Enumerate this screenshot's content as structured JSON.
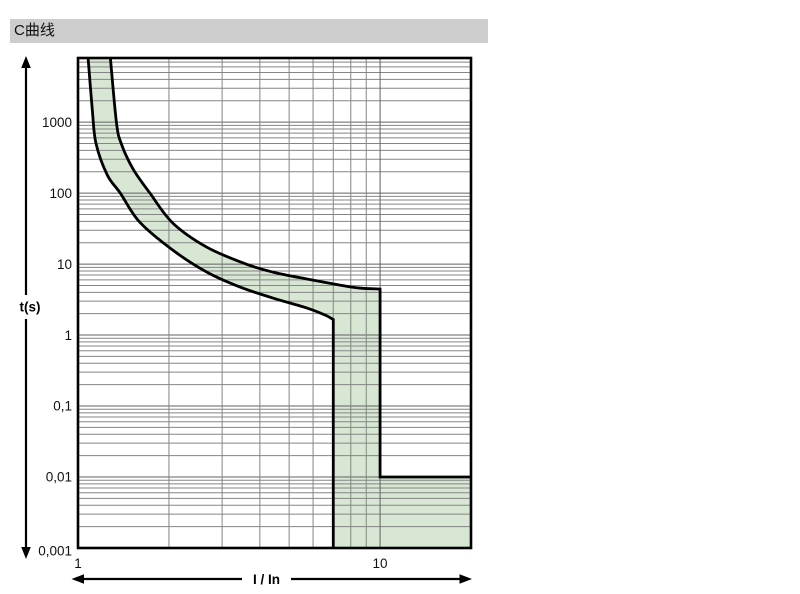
{
  "header": {
    "title": "C曲线",
    "bar_color": "#cdcdcd"
  },
  "chart_data": {
    "type": "area",
    "title": "C曲线",
    "xlabel": "I / In",
    "ylabel": "t(s)",
    "x_scale": "log",
    "y_scale": "log",
    "xlim": [
      1,
      20
    ],
    "ylim": [
      0.001,
      8000
    ],
    "grid": true,
    "x_ticks": [
      {
        "value": 1,
        "label": "1"
      },
      {
        "value": 10,
        "label": "10"
      }
    ],
    "y_ticks": [
      {
        "value": 1000,
        "label": "1000"
      },
      {
        "value": 100,
        "label": "100"
      },
      {
        "value": 10,
        "label": "10"
      },
      {
        "value": 1,
        "label": "1"
      },
      {
        "value": 0.1,
        "label": "0,1"
      },
      {
        "value": 0.01,
        "label": "0,01"
      },
      {
        "value": 0.001,
        "label": "0,001"
      }
    ],
    "series": [
      {
        "name": "lower-trip-limit",
        "curve": [
          [
            1.08,
            8000
          ],
          [
            1.115,
            1500
          ],
          [
            1.147,
            500
          ],
          [
            1.25,
            180
          ],
          [
            1.38,
            100
          ],
          [
            1.6,
            39
          ],
          [
            2.06,
            15.7
          ],
          [
            2.67,
            7.7
          ],
          [
            3.44,
            4.74
          ],
          [
            4.42,
            3.32
          ],
          [
            5.73,
            2.4
          ],
          [
            6.6,
            1.9
          ],
          [
            7.0,
            1.65
          ]
        ],
        "tail": [
          [
            7.0,
            0.001
          ]
        ]
      },
      {
        "name": "upper-trip-limit",
        "curve": [
          [
            1.28,
            8000
          ],
          [
            1.34,
            1000
          ],
          [
            1.39,
            500
          ],
          [
            1.52,
            220
          ],
          [
            1.73,
            100
          ],
          [
            2.06,
            37.8
          ],
          [
            2.67,
            17.3
          ],
          [
            3.6,
            10
          ],
          [
            4.42,
            7.7
          ],
          [
            5.73,
            6.15
          ],
          [
            7.36,
            5.06
          ],
          [
            8.56,
            4.59
          ],
          [
            10.0,
            4.45
          ]
        ],
        "tail": [
          [
            10.0,
            0.01
          ],
          [
            20.0,
            0.01
          ]
        ]
      }
    ],
    "colors": {
      "band_fill": "#d7e7d4",
      "curve": "#000000",
      "grid_minor": "#858585",
      "grid_major": "#606060",
      "frame": "#000000",
      "text": "#111111"
    }
  }
}
